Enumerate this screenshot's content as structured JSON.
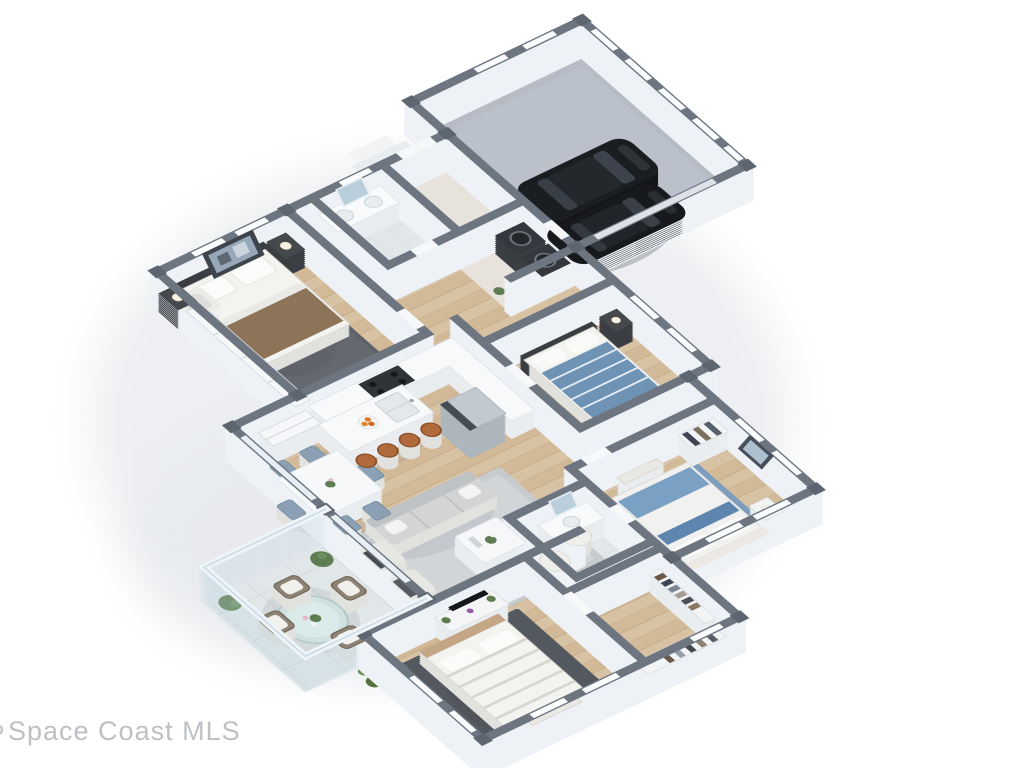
{
  "scene": {
    "type": "3d-floor-plan-render",
    "view": "isometric dollhouse, cutaway roof",
    "background": "#ffffff"
  },
  "watermark": {
    "text": "Space Coast MLS",
    "color": "#bdc1c5"
  },
  "summary": {
    "bedrooms": 4,
    "bathrooms": 2,
    "garage_cars": 2,
    "patio": true
  },
  "palette": {
    "wall_top": "#6d7581",
    "wall_face": "#eef2f6",
    "wood_floor": "#d8c2a4",
    "garage_floor": "#b5bcc5",
    "patio_tile": "#e1e7e9",
    "bath_tile": "#e4e7ea",
    "rug_dark": "#5b6169",
    "rug_blue": "#7e9cbd",
    "accent_blue": "#6f93b5",
    "stool_orange": "#b06a3c",
    "car_black": "#17191c",
    "plant_green": "#5f7d52",
    "shadow": "#e7eaee"
  },
  "rooms": [
    {
      "name": "garage",
      "items": [
        "black-car",
        "black-car",
        "concrete-floor",
        "paneled-walls"
      ]
    },
    {
      "name": "entry-foyer",
      "items": [
        "front-door",
        "porch-step",
        "tile-floor"
      ]
    },
    {
      "name": "laundry",
      "items": [
        "washer",
        "dryer"
      ]
    },
    {
      "name": "hall-bathroom",
      "items": [
        "double-vanity",
        "mirror",
        "toilet"
      ]
    },
    {
      "name": "master-bedroom",
      "items": [
        "king-bed",
        "dark-headboard",
        "nightstand-lamps",
        "dark-rug",
        "armchair",
        "wall-art",
        "closet-doors"
      ]
    },
    {
      "name": "kitchen",
      "items": [
        "l-shaped-counter",
        "stove",
        "island-with-sink",
        "four-orange-stools",
        "fruit-bowl",
        "refrigerator",
        "pantry-doors"
      ]
    },
    {
      "name": "dining-area",
      "items": [
        "white-table",
        "six-blue-chairs",
        "centerpiece"
      ]
    },
    {
      "name": "living-room",
      "items": [
        "gray-sofa",
        "two-armchairs",
        "two-poufs",
        "coffee-table",
        "light-rug"
      ]
    },
    {
      "name": "bedroom-2",
      "items": [
        "blue-striped-bed",
        "nightstand",
        "window"
      ]
    },
    {
      "name": "bedroom-3",
      "items": [
        "blue-white-bed",
        "blue-rug",
        "bench",
        "wall-art"
      ]
    },
    {
      "name": "bathroom-2",
      "items": [
        "vanity",
        "mirror",
        "toilet",
        "tile-floor"
      ]
    },
    {
      "name": "walk-in-closet",
      "items": [
        "shelving",
        "hanging-clothes"
      ]
    },
    {
      "name": "bedroom-4",
      "items": [
        "tan-headboard-bed",
        "striped-duvet",
        "tv-console",
        "plants",
        "dark-rug",
        "foot-bench"
      ]
    },
    {
      "name": "patio",
      "items": [
        "glass-walls",
        "round-glass-table",
        "four-wicker-chairs",
        "two-topiaries",
        "tile-floor"
      ]
    },
    {
      "name": "landscaping",
      "items": [
        "green-bushes"
      ]
    }
  ]
}
